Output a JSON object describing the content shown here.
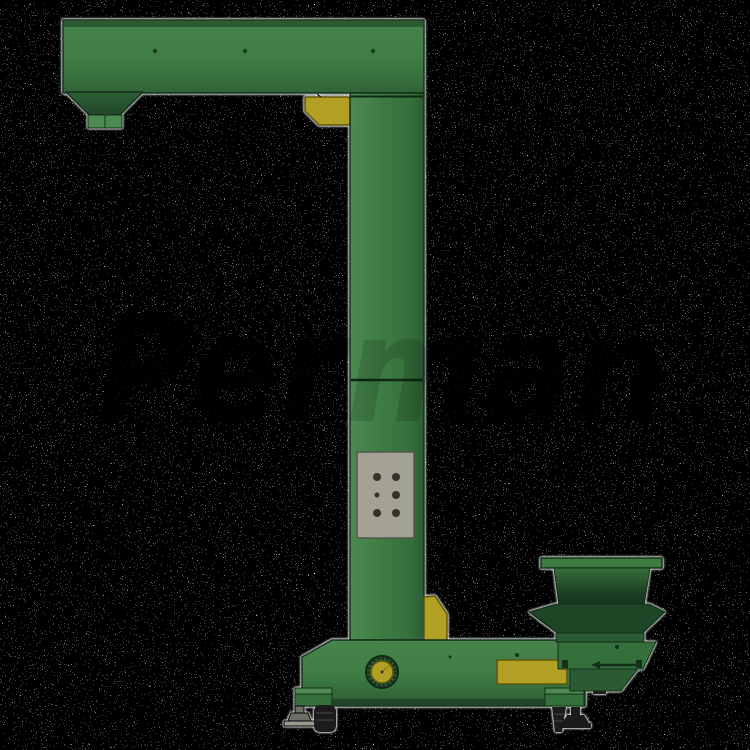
{
  "watermark": {
    "text": "Perman",
    "color": "#000000"
  },
  "background": {
    "base_color": "#000000",
    "speckle_color": "#ffffff"
  },
  "machine_colors": {
    "green_main": "#3E7C44",
    "green_light": "#4C8A52",
    "green_mid": "#35703C",
    "green_dark": "#2C5A33",
    "green_darkest": "#1E4226",
    "outline": "#14301A",
    "yellow": "#B1A024",
    "yellow_border": "#5F540E",
    "panel_gray": "#A3A295",
    "panel_border": "#55554A",
    "panel_hole": "#33332A",
    "foot_black": "#1B1B1B",
    "foot_gray": "#6E6E64",
    "foot_plate": "#9A9A8E"
  }
}
